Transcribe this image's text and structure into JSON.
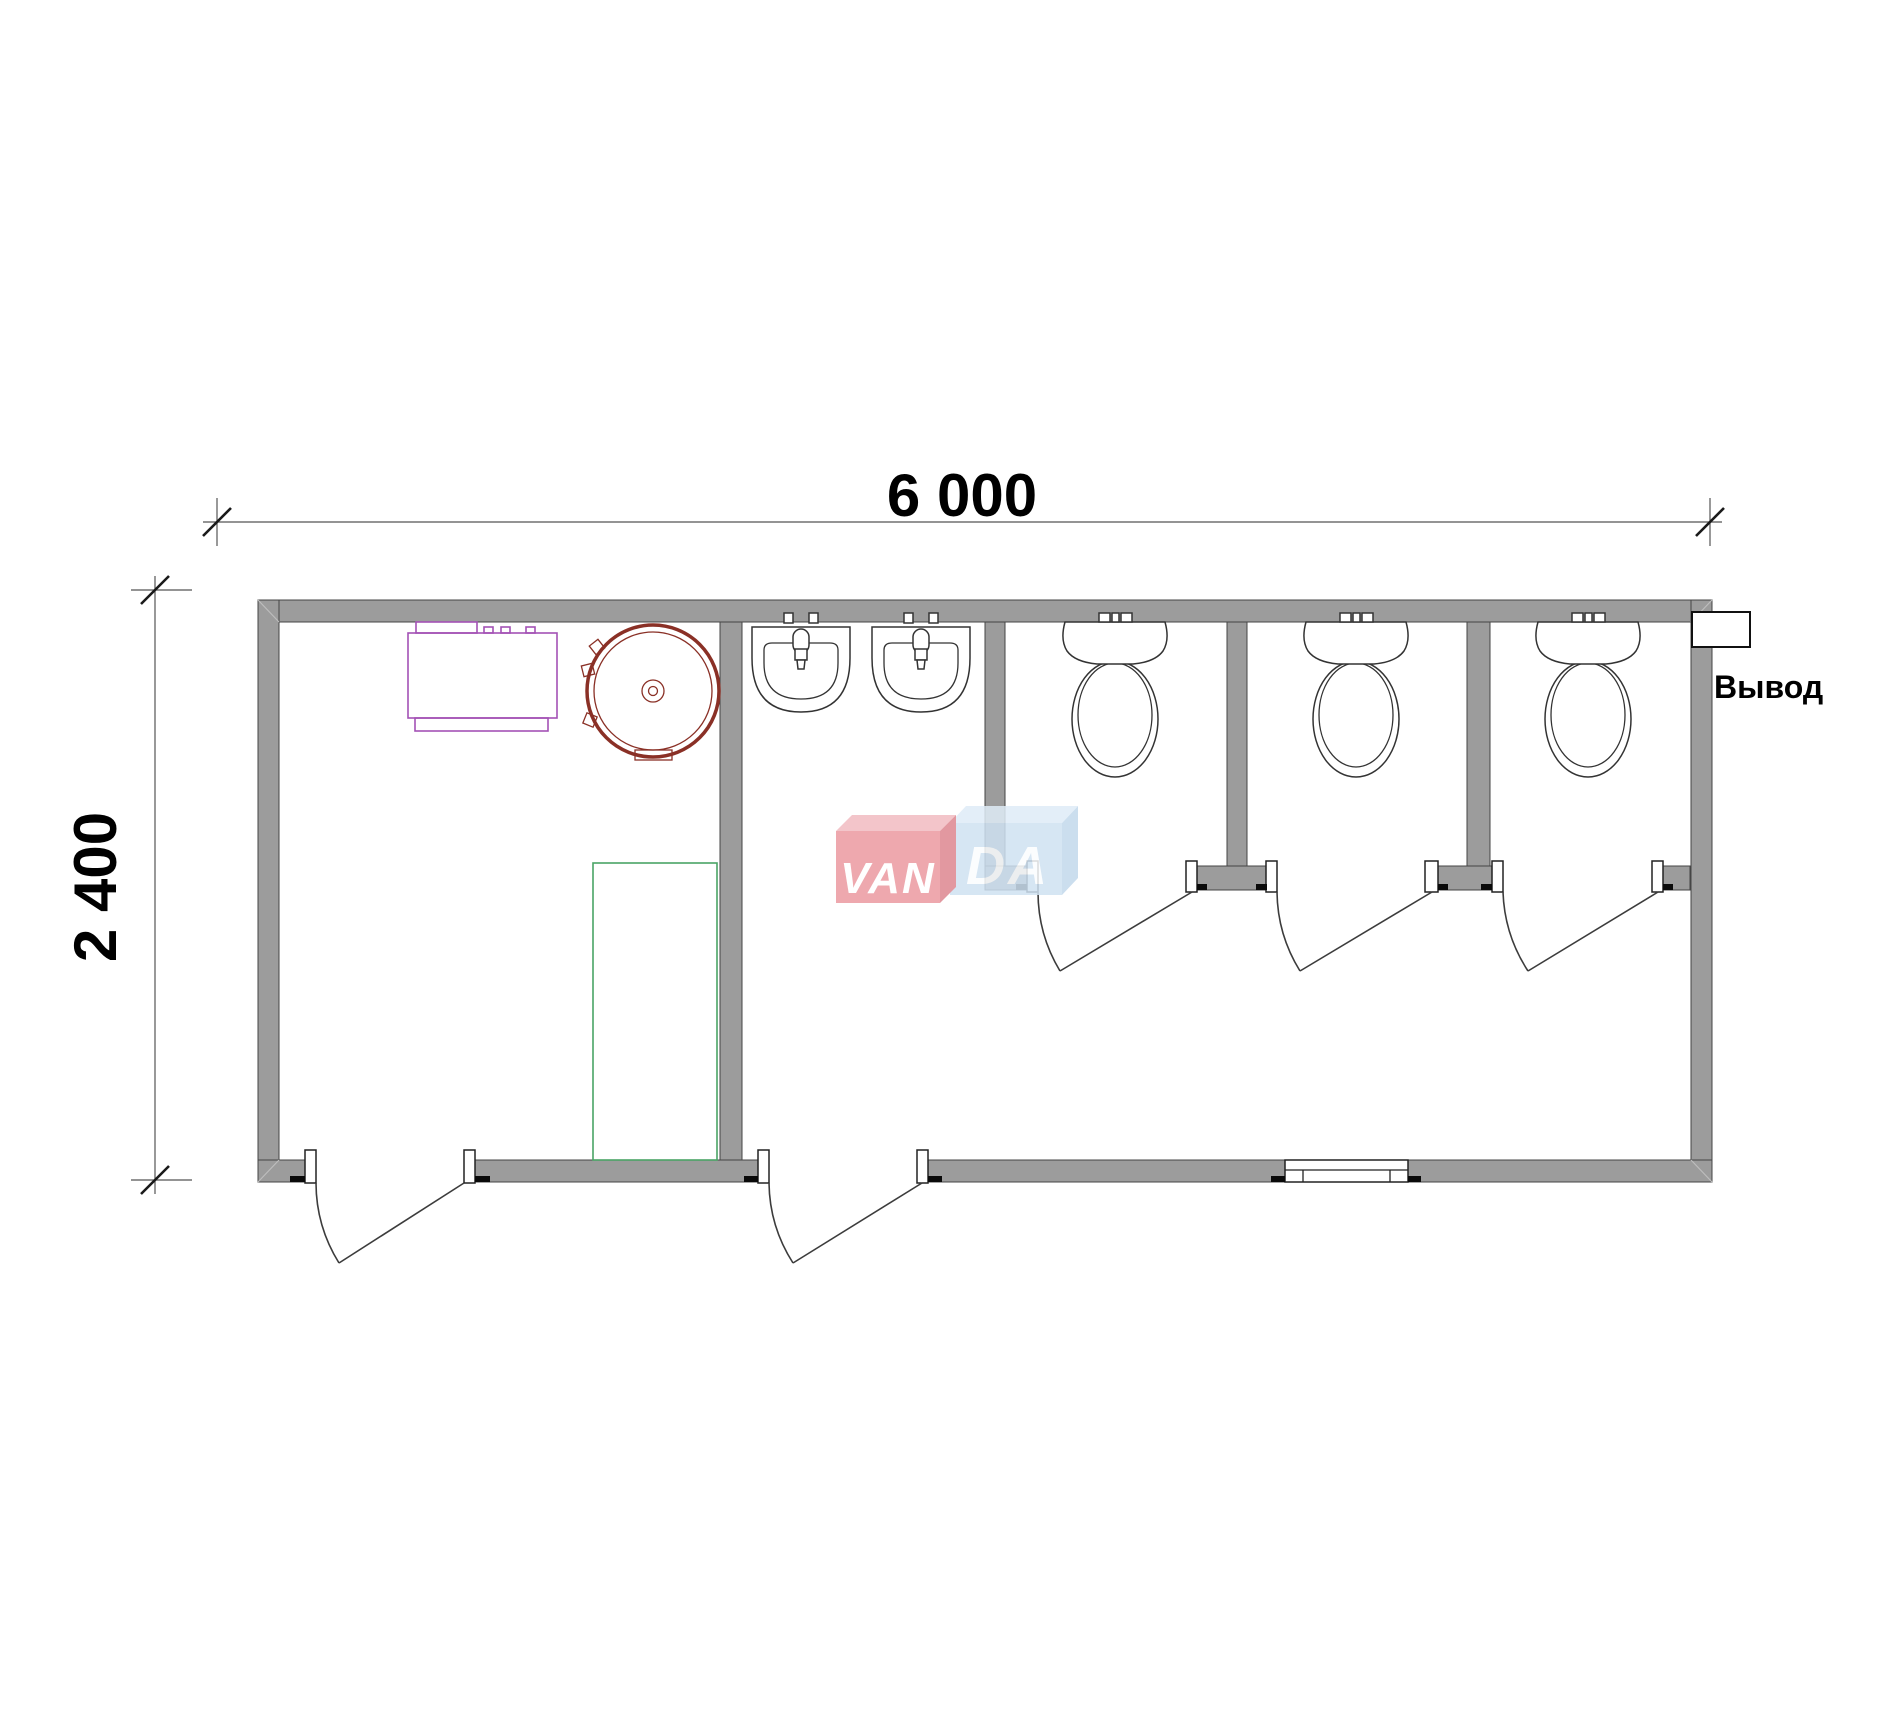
{
  "drawing": {
    "type": "floor-plan-sanitary-container",
    "dimensions": {
      "width_label": "6 000",
      "height_label": "2 400"
    },
    "annotations": {
      "outlet_label": "Вывод"
    },
    "watermark": {
      "full": "VANDA",
      "part1": "VAN",
      "part2": "DA",
      "red_box_color": "#ec9aa1",
      "blue_box_color": "#cfe2f2"
    },
    "colors": {
      "wall_fill": "#9c9c9c",
      "wall_edge": "#454545",
      "boiler_outline": "#8a3026",
      "cabinet_outline": "#a351b5",
      "shower_tray_outline": "#4aa466",
      "line_work": "#333333"
    },
    "fixtures": {
      "toilets": 3,
      "washbasins": 2,
      "water_heater_round": 1,
      "electric_cabinet": 1,
      "shower_tray": 1,
      "exterior_doors": 2,
      "stall_doors": 3,
      "windows": 1,
      "outlets": 1
    }
  }
}
